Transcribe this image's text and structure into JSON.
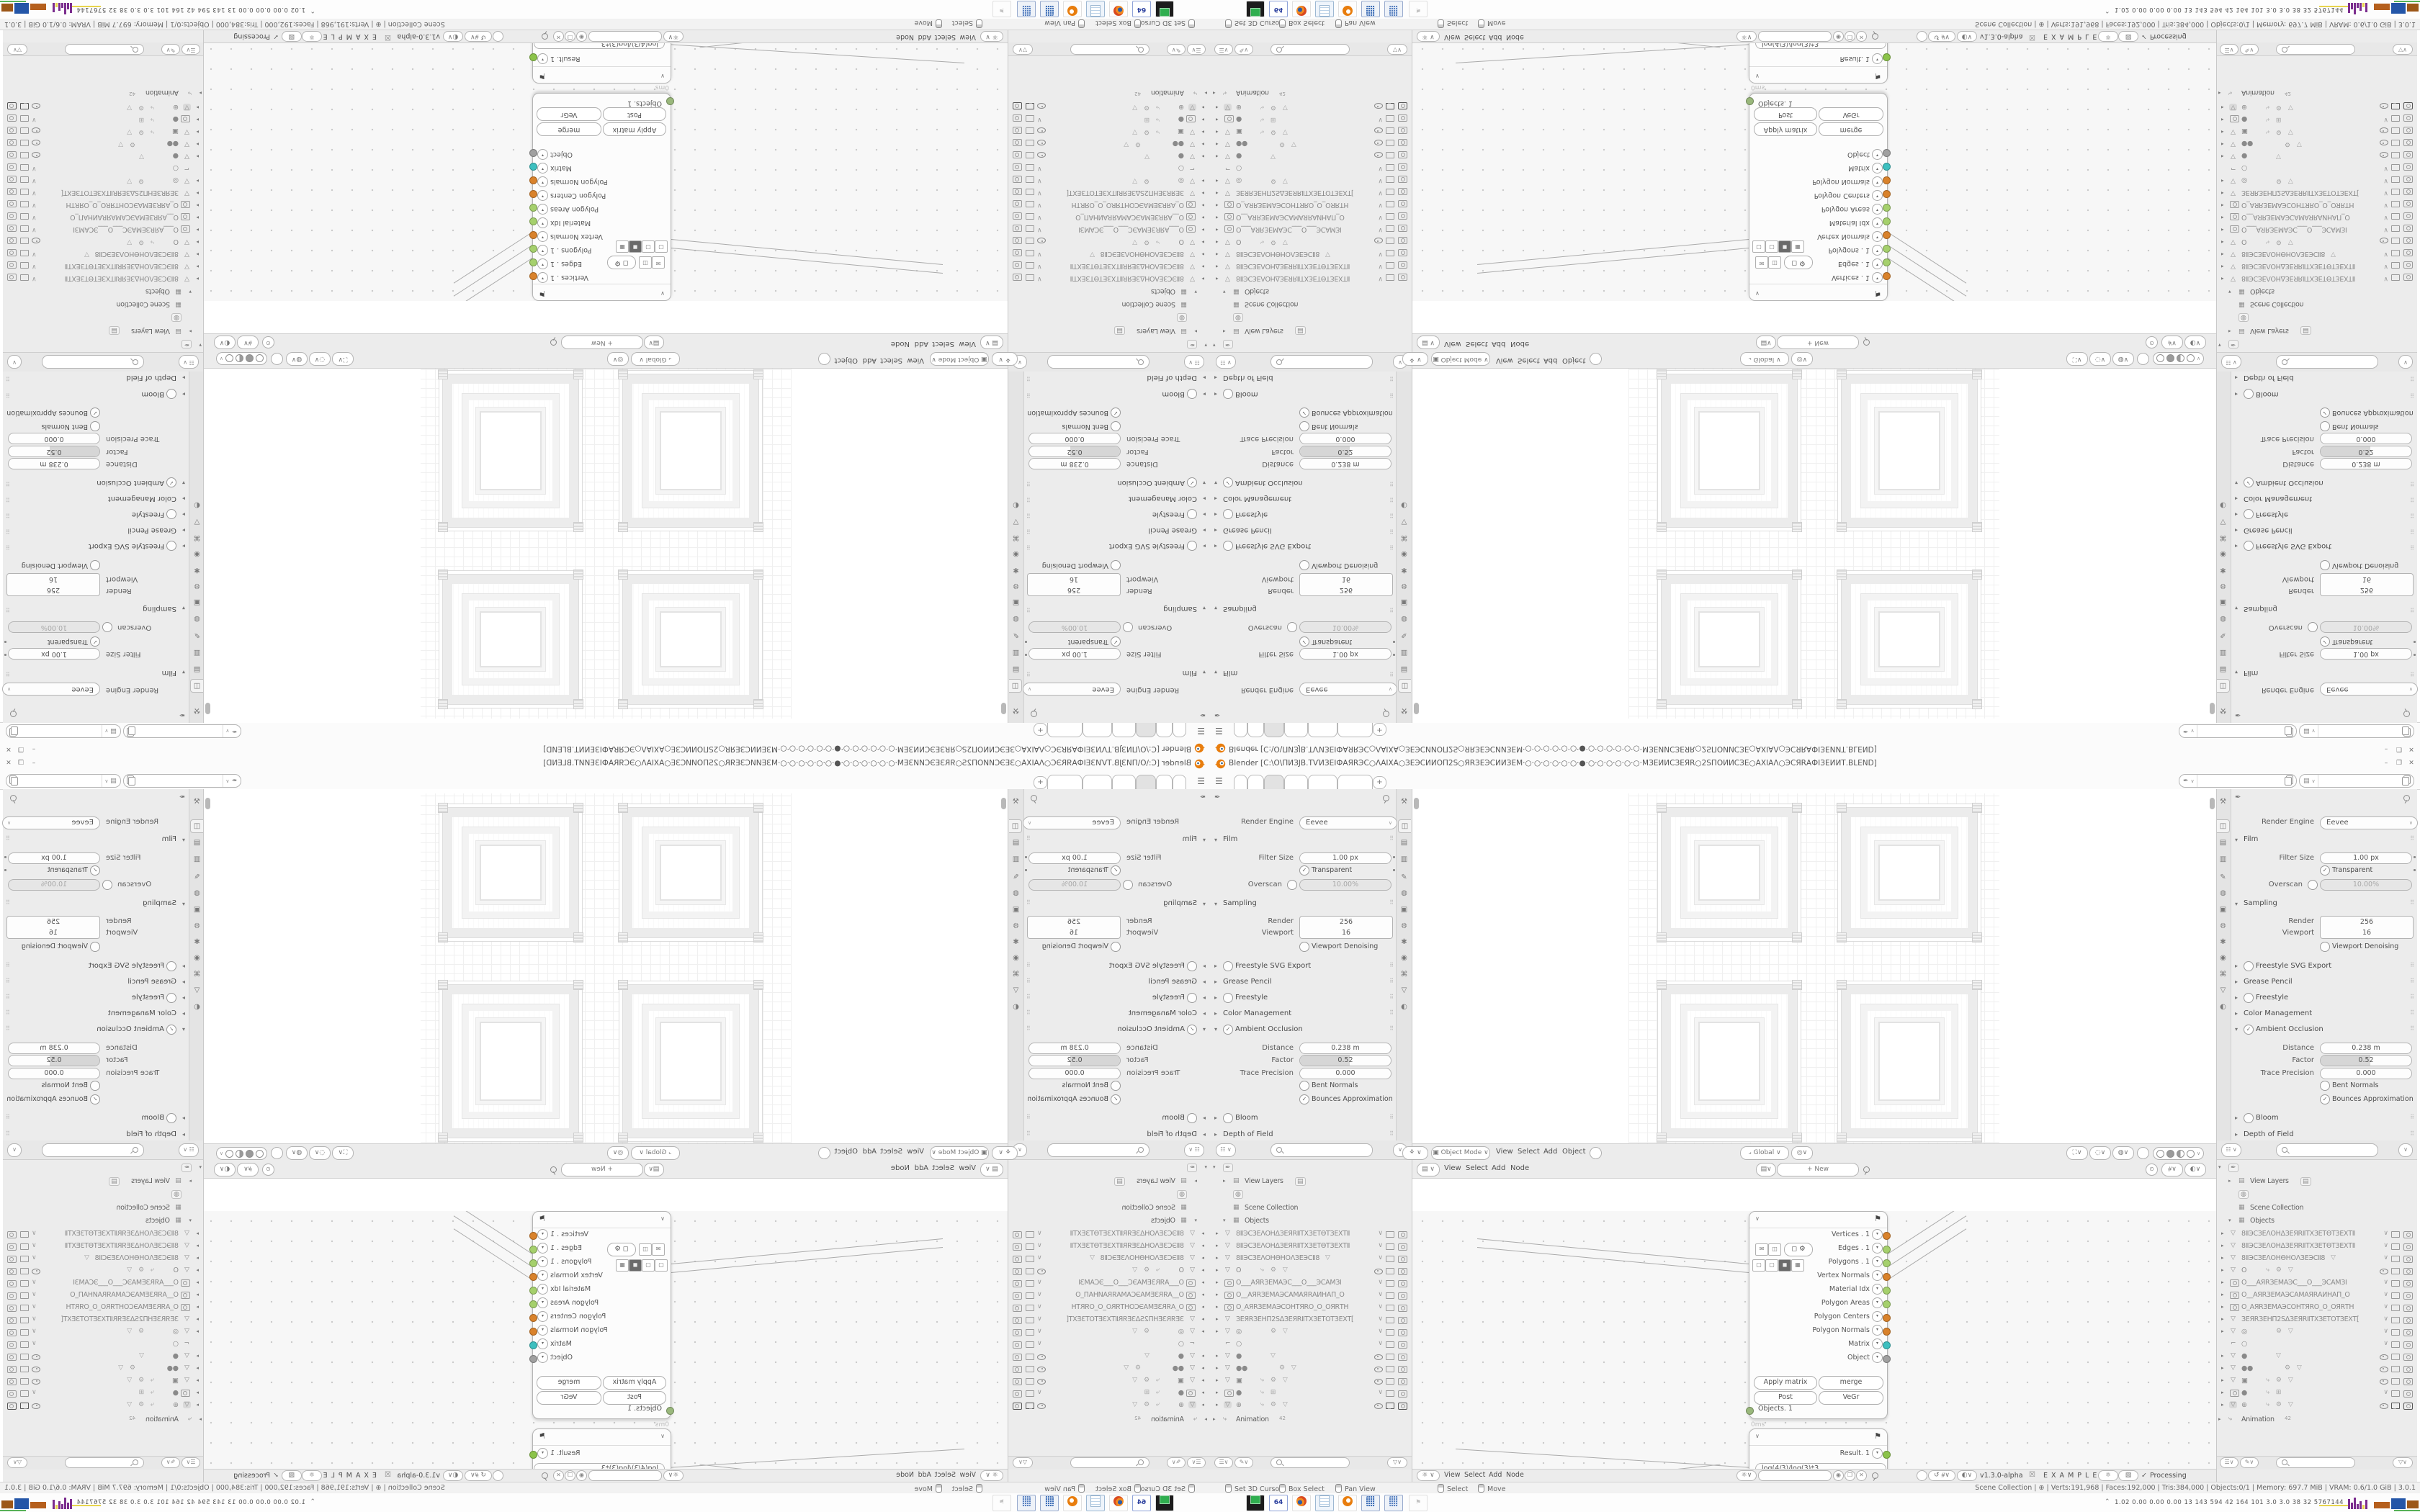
{
  "window": {
    "app_title": "Blender [C:\\O\\ПИЗJВ.ТѴИЗЕІФАЯRЭС○ΛАІХА○ЗЕЭСИИОП2S○ЯRЗЕЭСИИЗЕМ·○·○·○·○·○·○·●·○·○·○·○·○·○·МЗЕИИСЗЕЯR○2SПОИИСЗЕ○АХІАΛ○ЭСЯRАФІЗЕИИТ.BLEND]",
    "minimize": "–",
    "restore": "❐",
    "close": "✕"
  },
  "topbar": {
    "menu_icon": "☰",
    "add_tab": "+"
  },
  "props": {
    "render_engine_label": "Render Engine",
    "render_engine_value": "Eevee",
    "film": "Film",
    "filter_size": "Filter Size",
    "filter_size_value": "1.00 px",
    "transparent": "Transparent",
    "overscan": "Overscan",
    "overscan_value": "10.00%",
    "sampling": "Sampling",
    "render": "Render",
    "render_value": "256",
    "viewport": "Viewport",
    "viewport_value": "16",
    "viewport_denoising": "Viewport Denoising",
    "freestyle_svg": "Freestyle SVG Export",
    "grease_pencil": "Grease Pencil",
    "freestyle": "Freestyle",
    "color_management": "Color Management",
    "ambient_occlusion": "Ambient Occlusion",
    "distance": "Distance",
    "distance_value": "0.238 m",
    "factor": "Factor",
    "factor_value": "0.52",
    "trace_precision": "Trace Precision",
    "trace_precision_value": "0.000",
    "bent_normals": "Bent Normals",
    "bounces": "Bounces Approximation",
    "bloom": "Bloom",
    "dof": "Depth of Field"
  },
  "outliner": {
    "view_layers": "View Layers",
    "scene_collection": "Scene Collection",
    "objects_label": "Objects",
    "animation": "Animation",
    "anim_badge": "42",
    "objects": [
      {
        "name": "8ⅡЭСЗЕΛОНΔЗЕЯRⅡТХЗЕТѲТЗЕХТⅡ",
        "mids": ""
      },
      {
        "name": "8ⅡЭСЗЕΛОНΔЗЕЯRⅡТХЗЕТѲТЗЕХТⅡ",
        "mids": ""
      },
      {
        "name": "8ⅡЭСЗЕΛОНѲНОΛЗЕЭСⅡ8",
        "mids": "▽"
      },
      {
        "name": "O",
        "mids": "⤷ ⚙ ▽"
      },
      {
        "name": "O___АЯRЗЕМАЭС___O___ЭСАМЗІ",
        "mids": ""
      },
      {
        "name": "O__АЯRЗЕМАЭСАМАЯRАИНАП_O",
        "mids": ""
      },
      {
        "name": "O_АЯRЗЕМАЭСОНТЯRО_O_ОЯRТН",
        "mids": ""
      },
      {
        "name": "ЗЕЯRЗЕНП2SΔЗЕЯRⅡТХЗЕТОТЗЕХТ[",
        "mids": ""
      },
      {
        "name": "◎",
        "mids": "⚙ ▽"
      },
      {
        "name": "○",
        "mids": ""
      },
      {
        "name": "●",
        "mids": "▽"
      },
      {
        "name": "●●",
        "mids": "⚙ ▽"
      },
      {
        "name": "▣",
        "mids": "⤷ ⚙ ▽"
      },
      {
        "name": "●",
        "mids": "⤷ ⊞"
      },
      {
        "name": "⊕",
        "mids": "⤷ ⚙ ▽"
      }
    ]
  },
  "viewport": {
    "mode": "Object Mode",
    "m1": "View",
    "m2": "Select",
    "m3": "Add",
    "m4": "Object",
    "orientation": "Global"
  },
  "nodeed": {
    "m1": "View",
    "m2": "Select",
    "m3": "Add",
    "m4": "Node",
    "new_button": "+ New"
  },
  "sverchok": {
    "version": "v1.3.0-alpha",
    "examples": "E X A M P L E S",
    "check": "✓",
    "processing": "Processing"
  },
  "node_objects": {
    "outputs": [
      {
        "label": "Vertices",
        "suffix": ". 1",
        "color": "#d9822b"
      },
      {
        "label": "Edges",
        "suffix": ". 1",
        "color": "#a5d06c"
      },
      {
        "label": "Polygons",
        "suffix": ". 1",
        "color": "#a5d06c"
      },
      {
        "label": "Vertex Normals",
        "suffix": "",
        "color": "#d9822b"
      },
      {
        "label": "Material Idx",
        "suffix": "",
        "color": "#a5d06c"
      },
      {
        "label": "Polygon Areas",
        "suffix": "",
        "color": "#a5d06c"
      },
      {
        "label": "Polygon Centers",
        "suffix": "",
        "color": "#d9822b"
      },
      {
        "label": "Polygon Normals",
        "suffix": "",
        "color": "#d9822b"
      },
      {
        "label": "Matrix",
        "suffix": "",
        "color": "#3dbfbf"
      },
      {
        "label": "Object",
        "suffix": "",
        "color": "#a0a0a0"
      }
    ],
    "btn_apply": "Apply matrix",
    "btn_merge": "merge",
    "btn_post": "Post",
    "btn_vegr": "VeGr",
    "input_socket": "Objects. 1",
    "time": "0ms"
  },
  "node_result": {
    "output": "Result. 1",
    "formula": "log(4/3)/log(3)*3",
    "b_minus": "-1",
    "b_zero": "0",
    "b_plus": "+1"
  },
  "status": {
    "h1": "Set 3D Cursor",
    "h2": "Box Select",
    "h3": "Pan View",
    "h4": "Select",
    "h5": "Move",
    "stats": "Scene Collection | ⊕ | Verts:191,968 | Faces:192,000 | Tris:384,000 | Objects:0/1 | Memory: 697.7 MiB | VRAM: 0.6/1.0 GiB | 3.0.1"
  },
  "taskbar": {
    "i1": "",
    "i2": "64",
    "i3": "",
    "i4": "",
    "i5": "",
    "i6": "",
    "i7": "",
    "i8": ""
  },
  "perf": {
    "numbers": "1.02 0.00 0.00 0.00  13  143  594  42  164  101  3.0  3.0  38  32  5767144"
  }
}
